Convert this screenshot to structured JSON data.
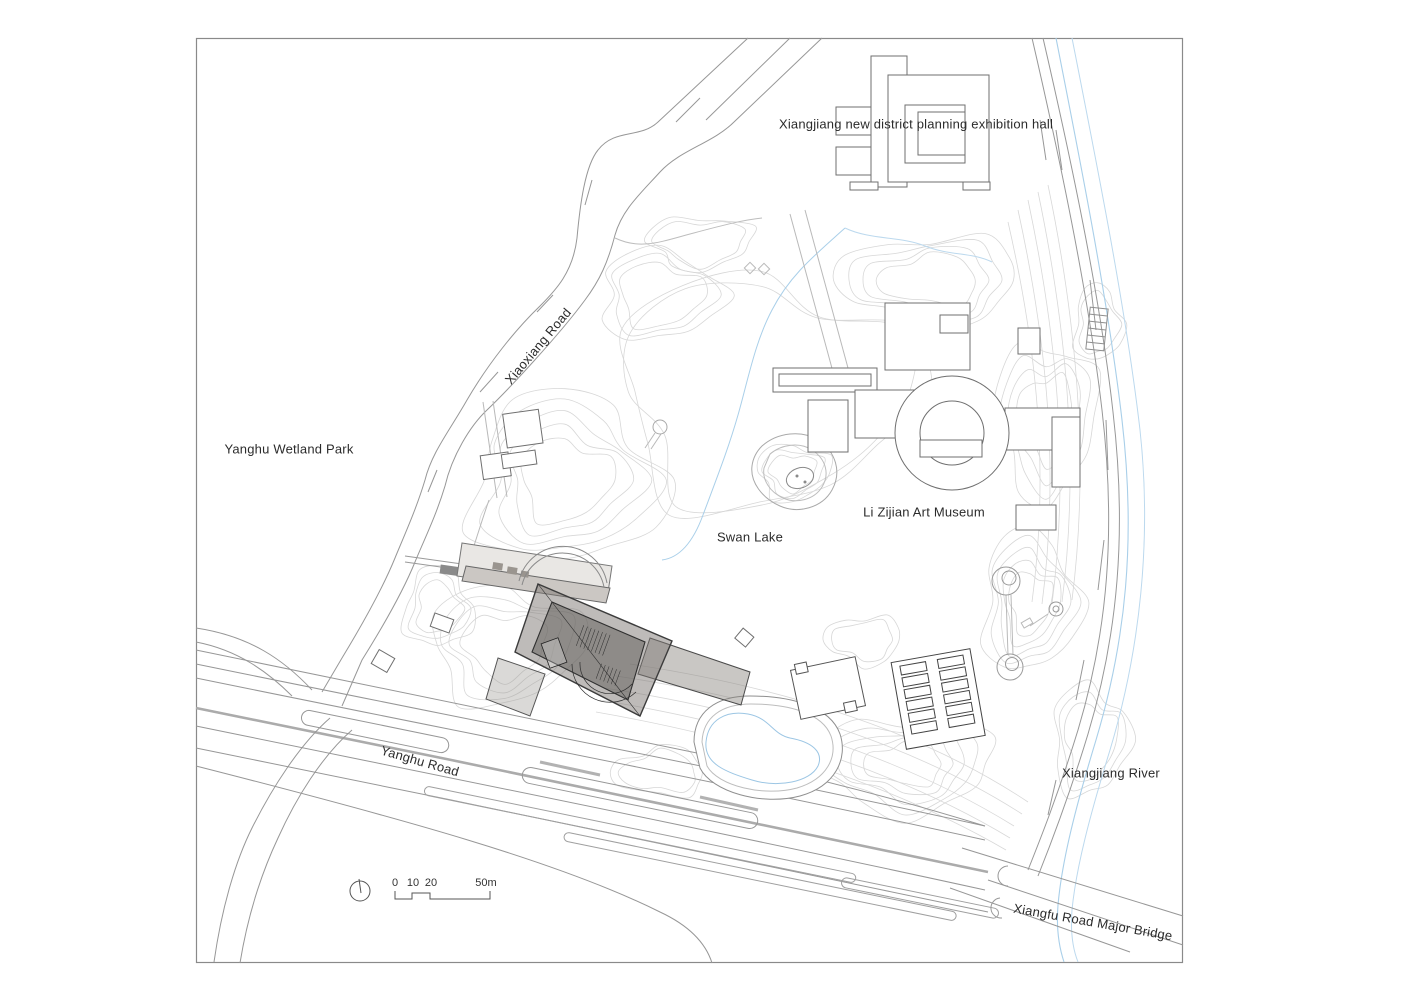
{
  "drawing": {
    "type": "architectural site plan",
    "labels": {
      "exhibition_hall": "Xiangjiang new district planning exhibition hall",
      "xiaoxiang_road": "Xiaoxiang Road",
      "yanghu_wetland_park": "Yanghu Wetland Park",
      "swan_lake": "Swan Lake",
      "li_zijian_art_museum": "Li Zijian Art Museum",
      "yanghu_road": "Yanghu Road",
      "xiangjiang_river": "Xiangjiang River",
      "xiangfu_bridge": "Xiangfu Road Major Bridge"
    },
    "scale_bar": {
      "ticks": [
        "0",
        "10",
        "20",
        "50m"
      ]
    },
    "icons": {
      "north_indicator": "north-indicator-icon"
    },
    "colors": {
      "paper": "#ffffff",
      "border": "#8a8a8a",
      "contour": "#d7d7d7",
      "road": "#979797",
      "water": "#a9cfe9",
      "building_outline": "#6f6f6f",
      "museum_dark": "#4a4643"
    }
  }
}
